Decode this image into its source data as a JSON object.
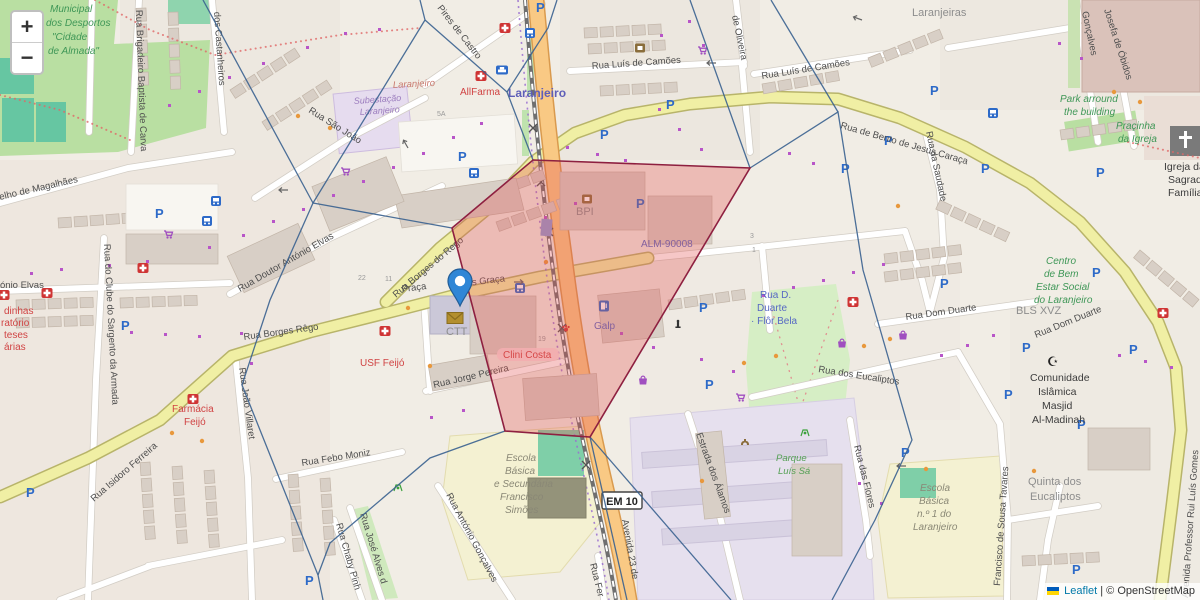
{
  "controls": {
    "zoom_in": "+",
    "zoom_out": "−"
  },
  "attribution": {
    "leaflet_label": "Leaflet",
    "separator": "|",
    "osm_label": "© OpenStreetMap"
  },
  "icons": {
    "parking": "P",
    "mosque": "☪"
  },
  "overlay": {
    "polygon_points": "533,160 750,168 590,437 505,431 452,228",
    "marker": {
      "x": 460,
      "y": 305
    }
  },
  "labels": {
    "sports1": "Municipal",
    "sports2": "dos Desportos",
    "sports3": "\"Cidade",
    "sports4": "de Almada\"",
    "brigadeiro": "Rua Brigadeiro Baptista de Carva",
    "castanheiros": "dos Castanheiros",
    "pires": "Pires de Castro",
    "camoes1": "Rua Luís de Camões",
    "camoes2": "Rua Luís de Camões",
    "bento": "Rua de Bento de Jesus Caraça",
    "laranjeiras": "Laranjeiras",
    "goncalves": "Gonçalves",
    "josefa": "Josefa de Óbidos",
    "park1": "Park arround",
    "park2": "the building",
    "park3": "Praçinha",
    "park4": "da Igreja",
    "igreja1": "Igreja da",
    "igreja2": "Sagrada",
    "igreja3": "Família",
    "saudade": "Rua da Saudade",
    "saojoao": "Rua São João",
    "laranjeiro_red": "Laranjeiro",
    "subestacao1": "Subestação",
    "subestacao2": "Laranjeiro",
    "allfarma": "AllFarma",
    "station": "Laranjeiro",
    "doutor": "Rua Doutor António Elvas",
    "borges_ne": "Rua Borges do Rego",
    "borges_w": "Rua Borges Rêgo",
    "magalhaes": "elho de Magalhães",
    "onio": "ónio Elvas",
    "red1": "dinhas",
    "red2": "ratório",
    "red3": "teses",
    "red4": "árias",
    "sargento": "Rua do Clube do Sargento da Armada",
    "isidoro": "Rua Isidoro Ferreira",
    "farmacia1": "Farmácia",
    "farmacia2": "Feijó",
    "usf": "USF Feijó",
    "villaret": "Rua João Villaret",
    "febo": "Rua Febo Moniz",
    "jose": "Rua José Alves d",
    "chaby": "Rua Chaby Pinh",
    "antonio": "Rua António Gonçalves",
    "praca": "Praça",
    "esgraca": "es Graça",
    "ctt": "CTT",
    "clini": "Clini Costa",
    "jorge": "Rua Jorge Pereira",
    "bpi": "BPI",
    "alm": "ALM-90008",
    "galp": "Galp",
    "dd1": "Rua D.",
    "dd2": "Duarte",
    "dd3": "· Flôr Bela",
    "domduarte1": "Rua Dom Duarte",
    "domduarte2": "Rua Dom Duarte",
    "eucaliptos": "Rua dos Eucaliptos",
    "parque1": "Parque",
    "parque2": "Luís Sá",
    "alamos": "Estrada dos Álamos",
    "flores": "Rua das Flores",
    "quinta1": "Quinta dos",
    "quinta2": "Eucaliptos",
    "en1a": "Escola",
    "en1b": "Básica",
    "en1c": "n.º 1 do",
    "en1d": "Laranjeiro",
    "tavares": "Francisco de Sousa Tavares",
    "avgomes": "Avenida Professor Rui Luís Gomes",
    "efs1": "Escola",
    "efs2": "Básica",
    "efs3": "e Secundária",
    "efs4": "Francisco",
    "efs5": "Simões",
    "em10": "EM 10",
    "av23": "Avenida 23 de",
    "ruafer": "Rua Fer",
    "centro1": "Centro",
    "centro2": "de Bem",
    "centro3": "Estar Social",
    "centro4": "do Laranjeiro",
    "bls": "BLS XVZ",
    "mesq1": "Comunidade",
    "mesq2": "Islâmica",
    "mesq3": "Masjid",
    "mesq4": "Al-Madinah",
    "oliveira": "de Oliveira",
    "n5a": "5A",
    "n22": "22",
    "n11": "11",
    "n19": "19",
    "n3": "3",
    "n1": "1"
  }
}
